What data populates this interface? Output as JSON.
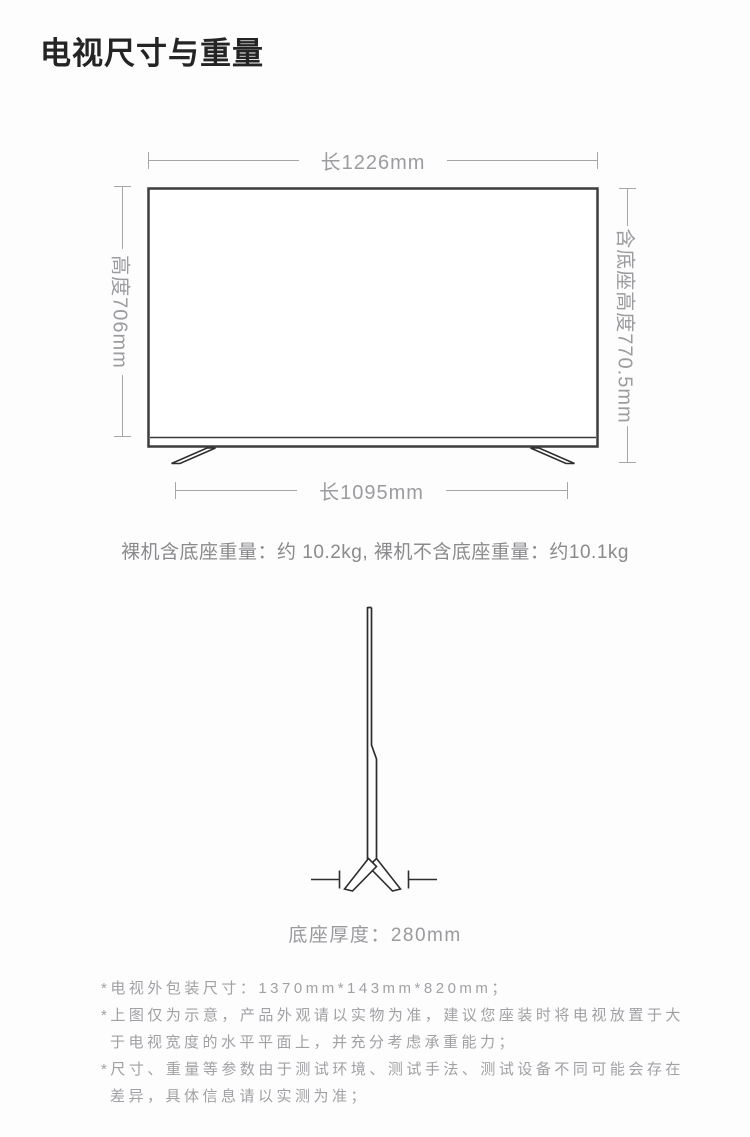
{
  "title": "电视尺寸与重量",
  "front_view": {
    "top_dim": "长1226mm",
    "left_dim": "高度706mm",
    "right_dim": "含底座高度770.5mm",
    "bottom_dim": "长1095mm"
  },
  "weight_line": "裸机含底座重量：约 10.2kg, 裸机不含底座重量：约10.1kg",
  "side_view": {
    "base_depth_label": "底座厚度：280mm"
  },
  "footnotes": [
    "*电视外包装尺寸：1370mm*143mm*820mm；",
    "*上图仅为示意，产品外观请以实物为准，建议您座装时将电视放置于大于电视宽度的水平平面上，并充分考虑承重能力；",
    "*尺寸、重量等参数由于测试环境、测试手法、测试设备不同可能会存在差异，具体信息请以实测为准；"
  ],
  "colors": {
    "title": "#242424",
    "tv_outline": "#3d3d3d",
    "dimension_gray": "#a6a6a6",
    "body_gray": "#8a8a8d",
    "note_gray": "#a1a1a5",
    "background": "#fdfdfd"
  }
}
